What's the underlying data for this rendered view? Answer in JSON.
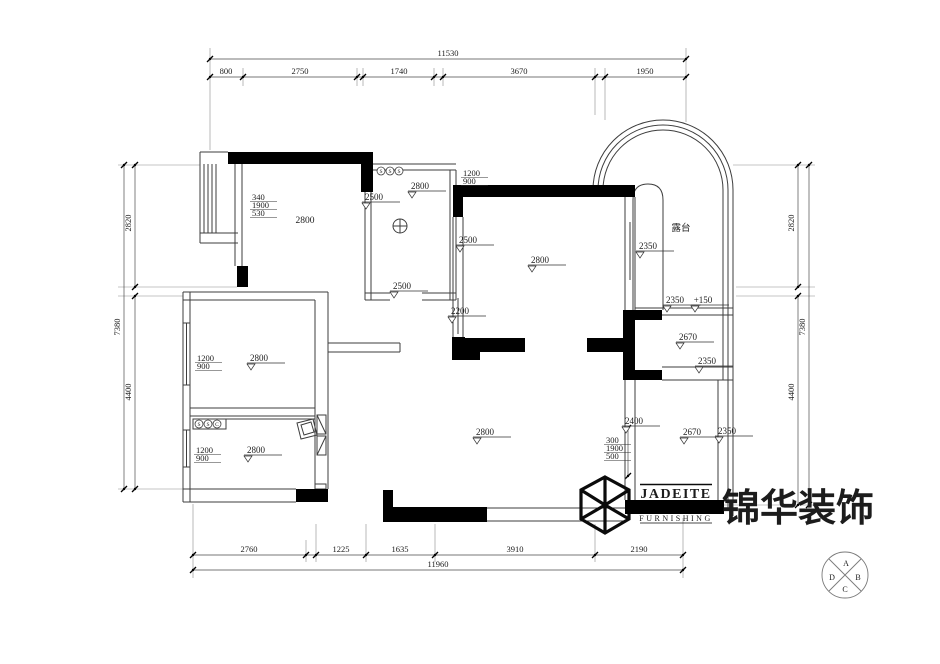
{
  "drawing": {
    "type": "apartment ceiling / floor plan (CAD)",
    "line_color": "#3d3d3d",
    "dim_color": "#4a4a4a",
    "wall_color": "#000000",
    "room_plain_labels": [
      {
        "text": "2800",
        "x": 305,
        "y": 223
      },
      {
        "text": "露台",
        "x": 681,
        "y": 231
      }
    ],
    "dim_labels": [
      {
        "text": "11530",
        "x": 448,
        "y": 56
      },
      {
        "text": "800",
        "x": 226,
        "y": 74
      },
      {
        "text": "2750",
        "x": 300,
        "y": 74
      },
      {
        "text": "1740",
        "x": 399,
        "y": 74
      },
      {
        "text": "3670",
        "x": 519,
        "y": 74
      },
      {
        "text": "1950",
        "x": 645,
        "y": 74
      },
      {
        "text": "2760",
        "x": 249,
        "y": 552
      },
      {
        "text": "1225",
        "x": 341,
        "y": 552
      },
      {
        "text": "1635",
        "x": 400,
        "y": 552
      },
      {
        "text": "3910",
        "x": 515,
        "y": 552
      },
      {
        "text": "2190",
        "x": 639,
        "y": 552
      },
      {
        "text": "11960",
        "x": 438,
        "y": 567
      },
      {
        "text": "2820",
        "x": 131,
        "y": 223,
        "rot": -90
      },
      {
        "text": "7380",
        "x": 120,
        "y": 327,
        "rot": -90
      },
      {
        "text": "4400",
        "x": 131,
        "y": 392,
        "rot": -90
      },
      {
        "text": "2820",
        "x": 794,
        "y": 223,
        "rot": -90
      },
      {
        "text": "7380",
        "x": 805,
        "y": 327,
        "rot": -90
      },
      {
        "text": "4400",
        "x": 794,
        "y": 392,
        "rot": -90
      }
    ],
    "chains": [
      {
        "o": "h",
        "y": 59,
        "a": 210,
        "b": 686,
        "ticks": [
          210,
          686
        ]
      },
      {
        "o": "h",
        "y": 77,
        "a": 210,
        "b": 686,
        "ticks": [
          210,
          243,
          357,
          363,
          434,
          443,
          595,
          605,
          686
        ]
      },
      {
        "o": "h",
        "y": 555,
        "a": 193,
        "b": 683,
        "ticks": [
          193,
          306,
          316,
          366,
          435,
          595,
          683
        ]
      },
      {
        "o": "h",
        "y": 570,
        "a": 193,
        "b": 683,
        "ticks": [
          193,
          683
        ]
      },
      {
        "o": "v",
        "x": 124,
        "a": 165,
        "b": 489,
        "ticks": [
          165,
          489
        ]
      },
      {
        "o": "v",
        "x": 135,
        "a": 165,
        "b": 287,
        "ticks": [
          165,
          287
        ]
      },
      {
        "o": "v",
        "x": 135,
        "a": 296,
        "b": 489,
        "ticks": [
          296,
          489
        ]
      },
      {
        "o": "v",
        "x": 798,
        "a": 165,
        "b": 287,
        "ticks": [
          165,
          287
        ]
      },
      {
        "o": "v",
        "x": 798,
        "a": 296,
        "b": 505,
        "ticks": [
          296,
          505
        ]
      },
      {
        "o": "v",
        "x": 809,
        "a": 165,
        "b": 505,
        "ticks": [
          165,
          505
        ]
      },
      {
        "o": "v",
        "x": 628,
        "a": 428,
        "b": 476,
        "ticks": [
          428,
          476
        ]
      }
    ],
    "ceiling_levels": [
      {
        "text": "2800",
        "x": 420,
        "y": 189
      },
      {
        "text": "2500",
        "x": 374,
        "y": 200
      },
      {
        "text": "2500",
        "x": 402,
        "y": 289
      },
      {
        "text": "2500",
        "x": 468,
        "y": 243
      },
      {
        "text": "2800",
        "x": 540,
        "y": 263
      },
      {
        "text": "2200",
        "x": 460,
        "y": 314
      },
      {
        "text": "2350",
        "x": 648,
        "y": 249
      },
      {
        "text": "2350",
        "x": 675,
        "y": 303
      },
      {
        "text": "+150",
        "x": 703,
        "y": 303
      },
      {
        "text": "2670",
        "x": 688,
        "y": 340
      },
      {
        "text": "2350",
        "x": 707,
        "y": 364
      },
      {
        "text": "2400",
        "x": 634,
        "y": 424
      },
      {
        "text": "2670",
        "x": 692,
        "y": 435
      },
      {
        "text": "2350",
        "x": 727,
        "y": 434
      },
      {
        "text": "2800",
        "x": 485,
        "y": 435
      },
      {
        "text": "2800",
        "x": 259,
        "y": 361
      },
      {
        "text": "2800",
        "x": 256,
        "y": 453
      }
    ],
    "stacked_dims": [
      {
        "lines": [
          "340",
          "1900",
          "530"
        ],
        "x": 252,
        "y": 200
      },
      {
        "lines": [
          "1200",
          "900"
        ],
        "x": 197,
        "y": 361
      },
      {
        "lines": [
          "1200",
          "900"
        ],
        "x": 196,
        "y": 453
      },
      {
        "lines": [
          "1200",
          "900"
        ],
        "x": 463,
        "y": 176
      },
      {
        "lines": [
          "300",
          "1900",
          "500"
        ],
        "x": 606,
        "y": 443
      }
    ],
    "symbol_rows": [
      {
        "glyphs": [
          "S",
          "S",
          "S"
        ],
        "x": 381,
        "y": 171,
        "dx": 9
      },
      {
        "glyphs": [
          "S",
          "S",
          "C"
        ],
        "x": 199,
        "y": 424,
        "dx": 9
      }
    ],
    "compass": {
      "letters": [
        {
          "text": "A",
          "x": 846,
          "y": 566
        },
        {
          "text": "B",
          "x": 858,
          "y": 580
        },
        {
          "text": "C",
          "x": 845,
          "y": 592
        },
        {
          "text": "D",
          "x": 832,
          "y": 580
        }
      ]
    }
  },
  "logo": {
    "brand": "JADEITE",
    "sub": "FURNISHING",
    "cn": "锦华装饰"
  }
}
